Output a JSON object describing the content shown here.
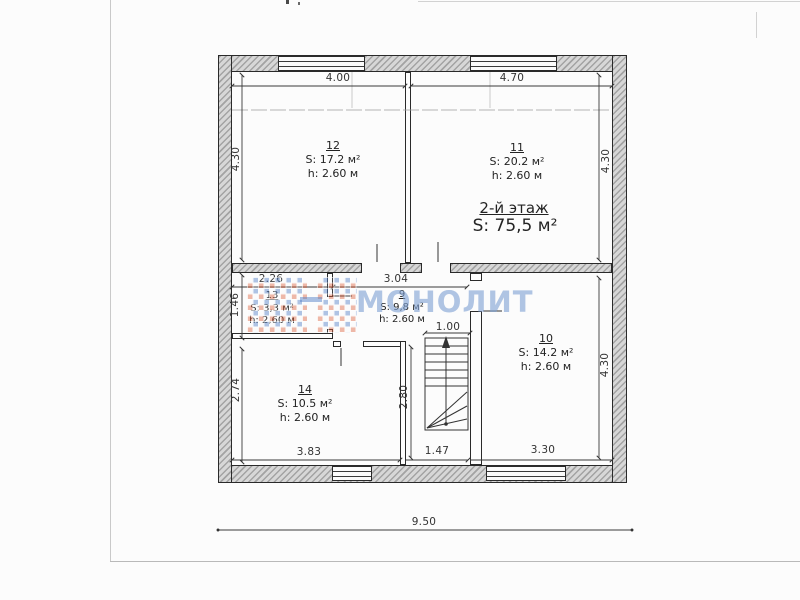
{
  "document": {
    "type_label": "floor-plan-scan",
    "colors": {
      "wall_fill": "#d7d7d7",
      "line": "#2a2a2a",
      "page": "#fcfcfc"
    }
  },
  "watermark": {
    "text": "МОНОЛИТ",
    "text_color": "rgba(128,162,212,0.62)",
    "logo_blue": "#5682c8",
    "logo_red": "#dc5f3c"
  },
  "floor": {
    "title": "2-й этаж",
    "area": "S: 75,5 м²"
  },
  "rooms": {
    "r12": {
      "number": "12",
      "area": "S: 17.2 м²",
      "height": "h: 2.60 м"
    },
    "r11": {
      "number": "11",
      "area": "S: 20.2 м²",
      "height": "h: 2.60 м"
    },
    "r13": {
      "number": "13",
      "area": "S: 3,3 м²",
      "height": "h: 2,60 м"
    },
    "r9": {
      "number": "9",
      "area": "S: 9,8 м²",
      "height": "h: 2.60 м"
    },
    "r14": {
      "number": "14",
      "area": "S: 10.5 м²",
      "height": "h: 2.60 м"
    },
    "r10": {
      "number": "10",
      "area": "S: 14.2 м²",
      "height": "h: 2.60 м"
    }
  },
  "dimensions": {
    "top_left": "4.00",
    "top_right": "4.70",
    "left_upper": "4.30",
    "right_upper": "4.30",
    "room13_width": "2.26",
    "hall_width": "3.04",
    "room13_depth": "1.46",
    "stair_width": "1.00",
    "room14_depth": "2.74",
    "corridor_depth": "2.80",
    "room14_width": "3.83",
    "corridor_width": "1.47",
    "room10_width": "3.30",
    "right_lower": "4.30",
    "total_width": "9.50"
  }
}
